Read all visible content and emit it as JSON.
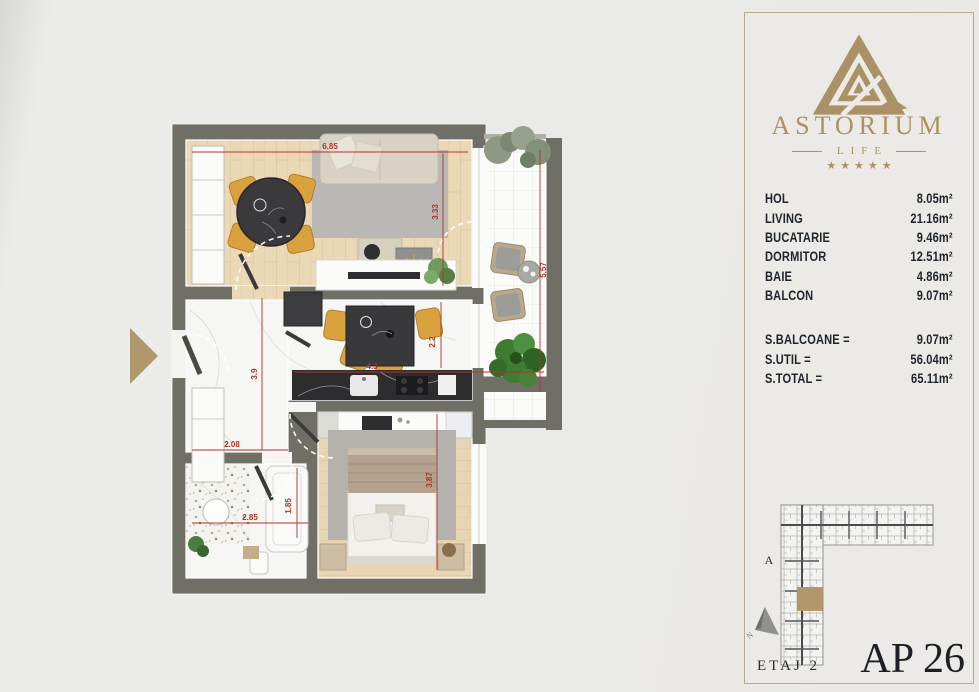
{
  "brand": {
    "name": "ASTORIUM",
    "tagline": "LIFE",
    "stars": "★★★★★"
  },
  "panel": {
    "rooms": [
      {
        "label": "HOL",
        "area": "8.05m²"
      },
      {
        "label": "LIVING",
        "area": "21.16m²"
      },
      {
        "label": "BUCATARIE",
        "area": "9.46m²"
      },
      {
        "label": "DORMITOR",
        "area": "12.51m²"
      },
      {
        "label": "BAIE",
        "area": "4.86m²"
      },
      {
        "label": "BALCON",
        "area": "9.07m²"
      }
    ],
    "totals": [
      {
        "label": "S.BALCOANE =",
        "value": "9.07m²"
      },
      {
        "label": "S.UTIL =",
        "value": "56.04m²"
      },
      {
        "label": "S.TOTAL =",
        "value": "65.11m²"
      }
    ],
    "building_label": "A",
    "compass_label": "N",
    "floor_label": "ETAJ 2",
    "apartment_label": "AP 26"
  },
  "plan": {
    "dims": {
      "living_width": "6.85",
      "living_depth": "3.33",
      "balcony_length": "5.57",
      "kitchen_width": "4.3",
      "kitchen_depth": "2.2",
      "hall_depth": "3.9",
      "hall_width": "2.08",
      "bath_width": "2.85",
      "bath_depth": "1.85",
      "bedroom_depth": "3.87"
    }
  },
  "colors": {
    "accent_gold": "#ab9266",
    "wall": "#6f6f66",
    "dimension_red": "#b03328",
    "highlight_unit": "#b0986c"
  }
}
